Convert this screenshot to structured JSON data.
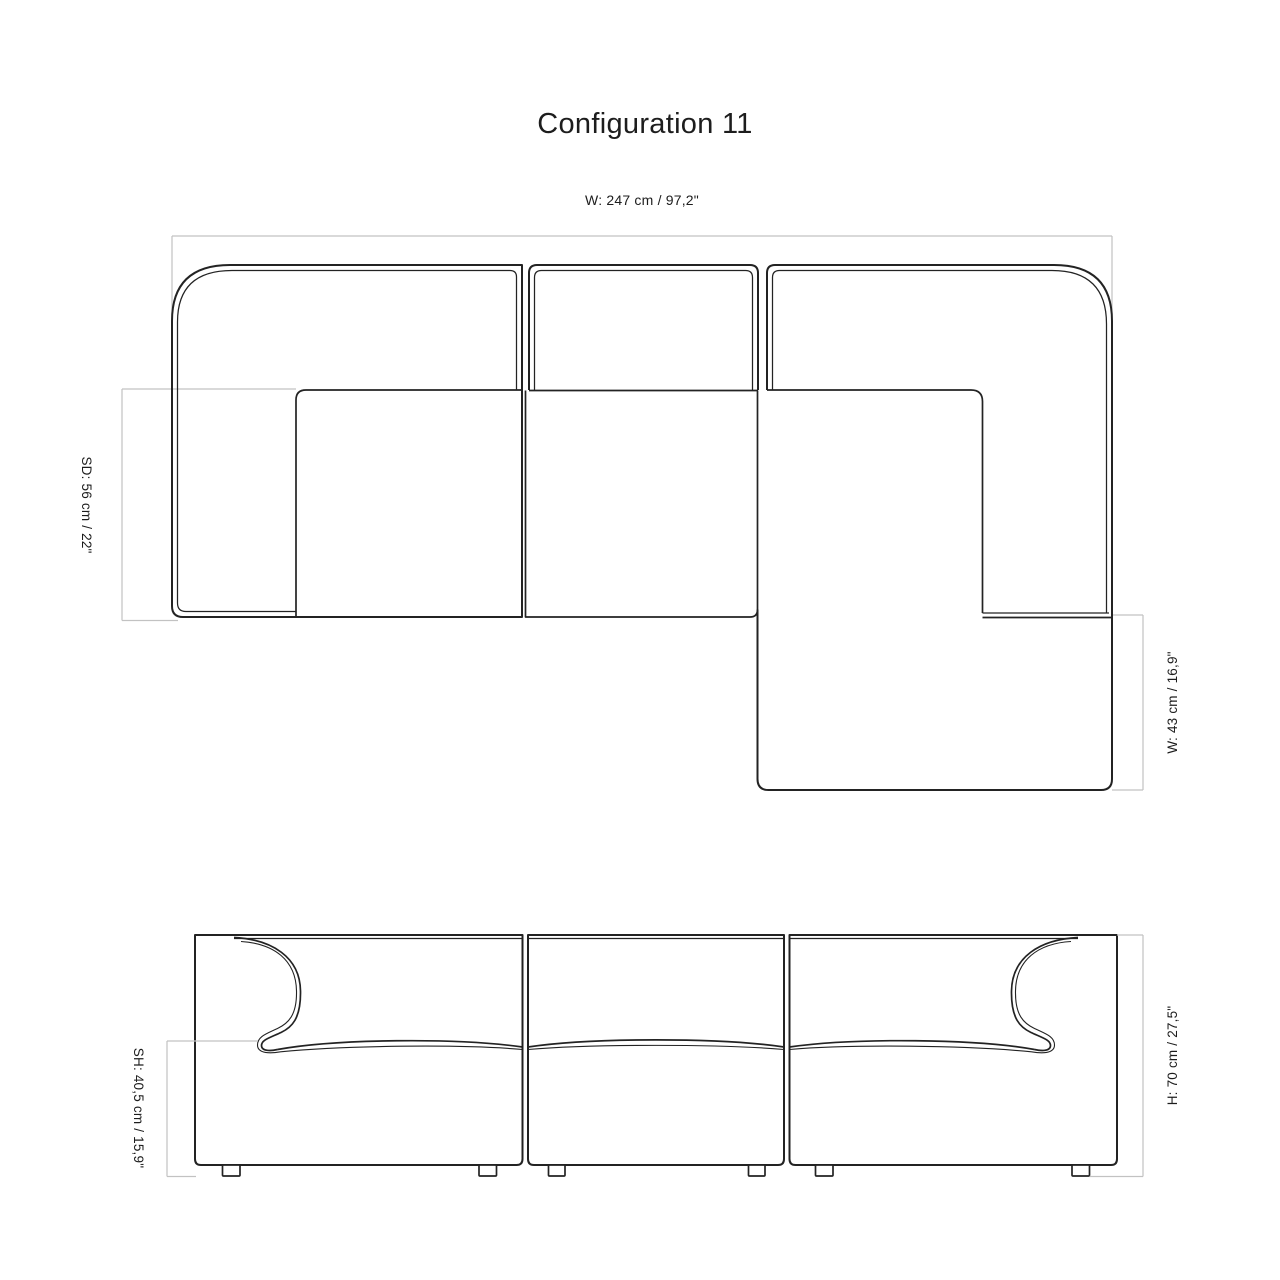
{
  "title": "Configuration 11",
  "top_view": {
    "width_label": "W: 247 cm / 97,2\"",
    "seat_depth_label": "SD: 56 cm / 22\"",
    "chaise_width_label": "W: 43 cm / 16,9\""
  },
  "front_view": {
    "seat_height_label": "SH: 40,5 cm / 15,9\"",
    "height_label": "H: 70 cm / 27,5\""
  },
  "colors": {
    "line": "#232323",
    "dimension_line": "#c2c2c2",
    "text": "#1d1d1d",
    "background": "#ffffff"
  }
}
